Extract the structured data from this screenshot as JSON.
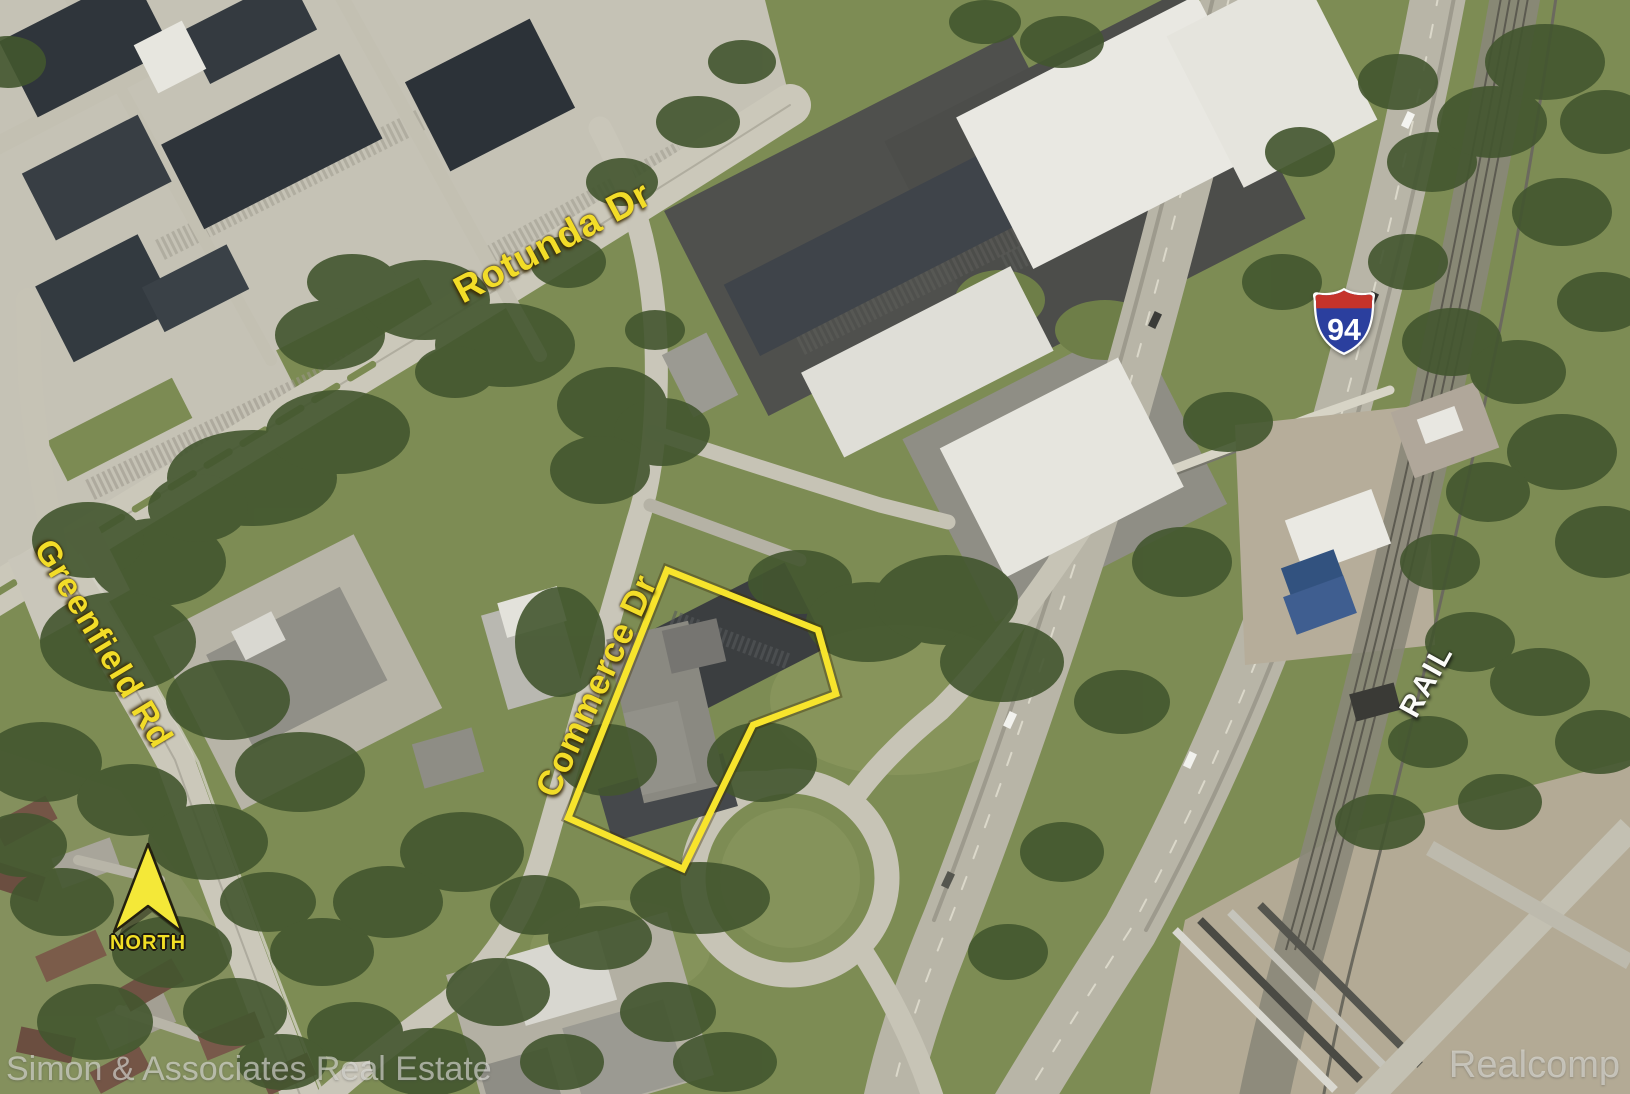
{
  "map": {
    "street_labels": [
      {
        "name": "rotunda-dr",
        "text": "Rotunda Dr"
      },
      {
        "name": "greenfield-rd",
        "text": "Greenfield Rd"
      },
      {
        "name": "commerce-dr",
        "text": "Commerce Dr"
      }
    ],
    "area_labels": [
      {
        "name": "rail-corridor",
        "text": "RAIL"
      }
    ],
    "highway_shield": {
      "system": "Interstate",
      "route_number": "94"
    },
    "north_indicator": {
      "label": "NORTH"
    },
    "property_outline": {
      "points": "667,570 818,630 836,694 753,725 683,869 568,818",
      "stroke_color": "#f7e42c"
    },
    "watermarks": {
      "bottom_left": "Simon & Associates Real Estate",
      "bottom_right": "Realcomp"
    },
    "colors": {
      "label_yellow": "#f2dc28",
      "outline_yellow": "#f7e42c",
      "shield_blue": "#2b3f9e",
      "shield_red": "#c5332b",
      "rail_label_white": "#fbfbf8",
      "north_arrow_yellow": "#f4e838"
    }
  }
}
